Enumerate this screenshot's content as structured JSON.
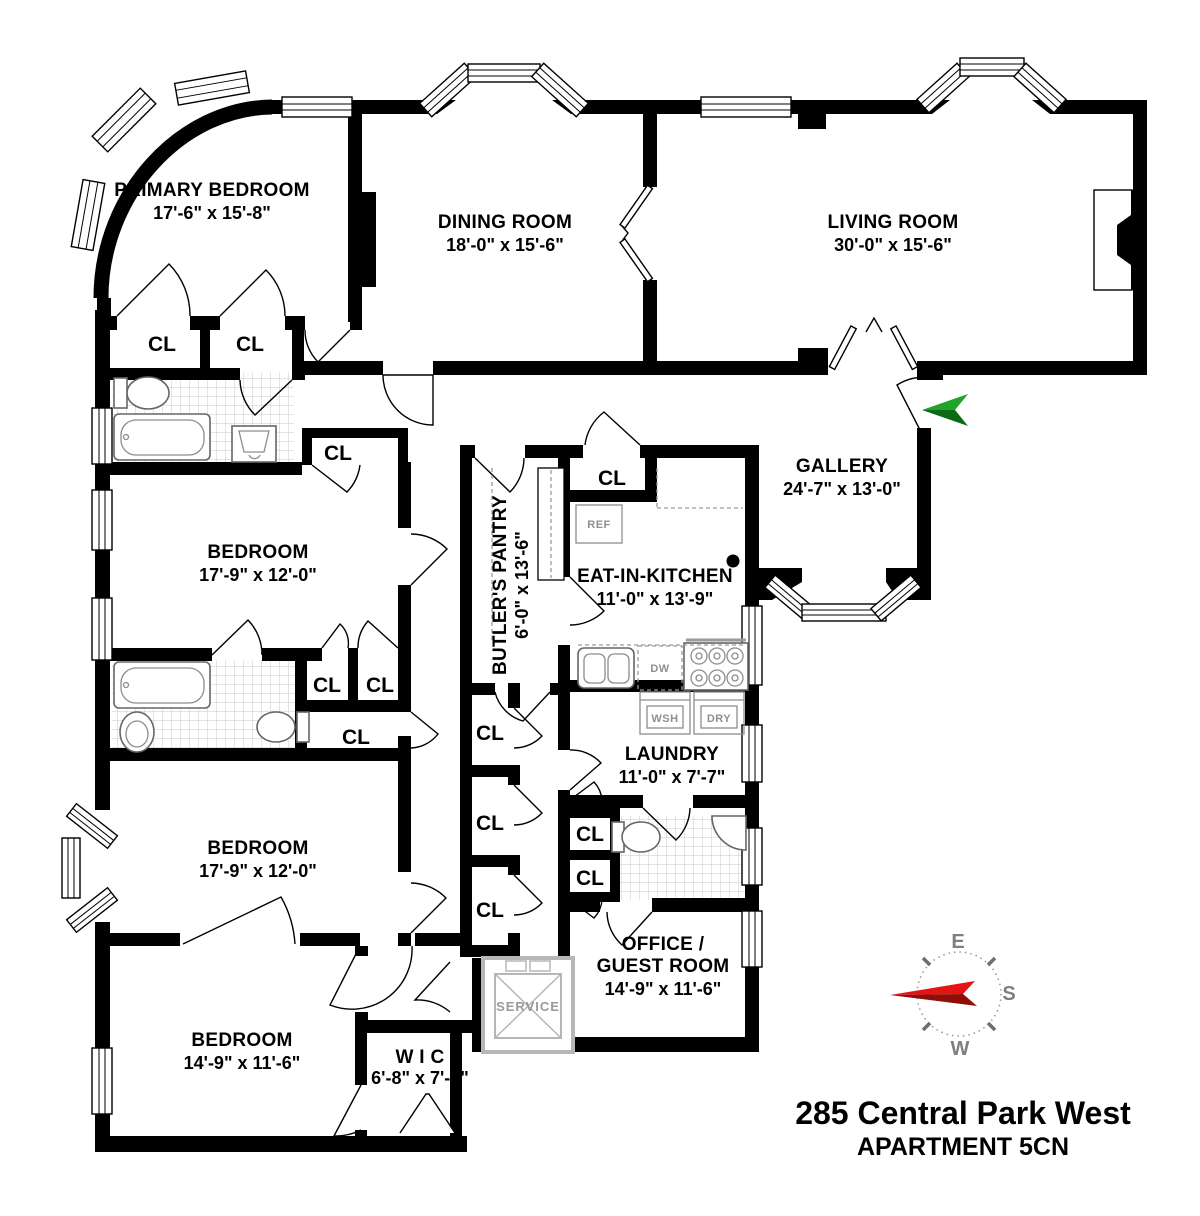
{
  "plan": {
    "rooms": {
      "primary_bedroom": {
        "name": "PRIMARY BEDROOM",
        "dims": "17'-6\" x 15'-8\""
      },
      "dining_room": {
        "name": "DINING ROOM",
        "dims": "18'-0\" x 15'-6\""
      },
      "living_room": {
        "name": "LIVING ROOM",
        "dims": "30'-0\" x 15'-6\""
      },
      "gallery": {
        "name": "GALLERY",
        "dims": "24'-7\" x 13'-0\""
      },
      "butlers_pantry": {
        "name": "BUTLER'S PANTRY",
        "dims": "6'-0\" x 13'-6\""
      },
      "eat_in_kitchen": {
        "name": "EAT-IN-KITCHEN",
        "dims": "11'-0\" x 13'-9\""
      },
      "bedroom_upper": {
        "name": "BEDROOM",
        "dims": "17'-9\" x 12'-0\""
      },
      "bedroom_middle": {
        "name": "BEDROOM",
        "dims": "17'-9\" x 12'-0\""
      },
      "laundry": {
        "name": "LAUNDRY",
        "dims": "11'-0\" x 7'-7\""
      },
      "office_guest": {
        "name1": "OFFICE /",
        "name2": "GUEST ROOM",
        "dims": "14'-9\" x 11'-6\""
      },
      "bedroom_lower": {
        "name": "BEDROOM",
        "dims": "14'-9\" x 11'-6\""
      },
      "wic": {
        "name": "W I C",
        "dims": "6'-8\" x 7'-4\""
      }
    },
    "closet_label": "CL",
    "appliances": {
      "refrigerator": "REF",
      "dishwasher": "DW",
      "washer": "WSH",
      "dryer": "DRY",
      "service_elevator": "SERVICE"
    },
    "compass": {
      "east": "E",
      "south": "S",
      "west": "W"
    },
    "footer": {
      "address": "285 Central Park West",
      "unit": "APARTMENT 5CN"
    },
    "colors": {
      "wall": "#000000",
      "entry_arrow_green": "#1fa32a",
      "entry_arrow_green_dark": "#0b6b15",
      "compass_needle_red": "#e51414",
      "compass_needle_dark_red": "#8f0f08",
      "fixture_gray": "#8f8f8f",
      "tile_gray": "#c9c9c9"
    }
  }
}
